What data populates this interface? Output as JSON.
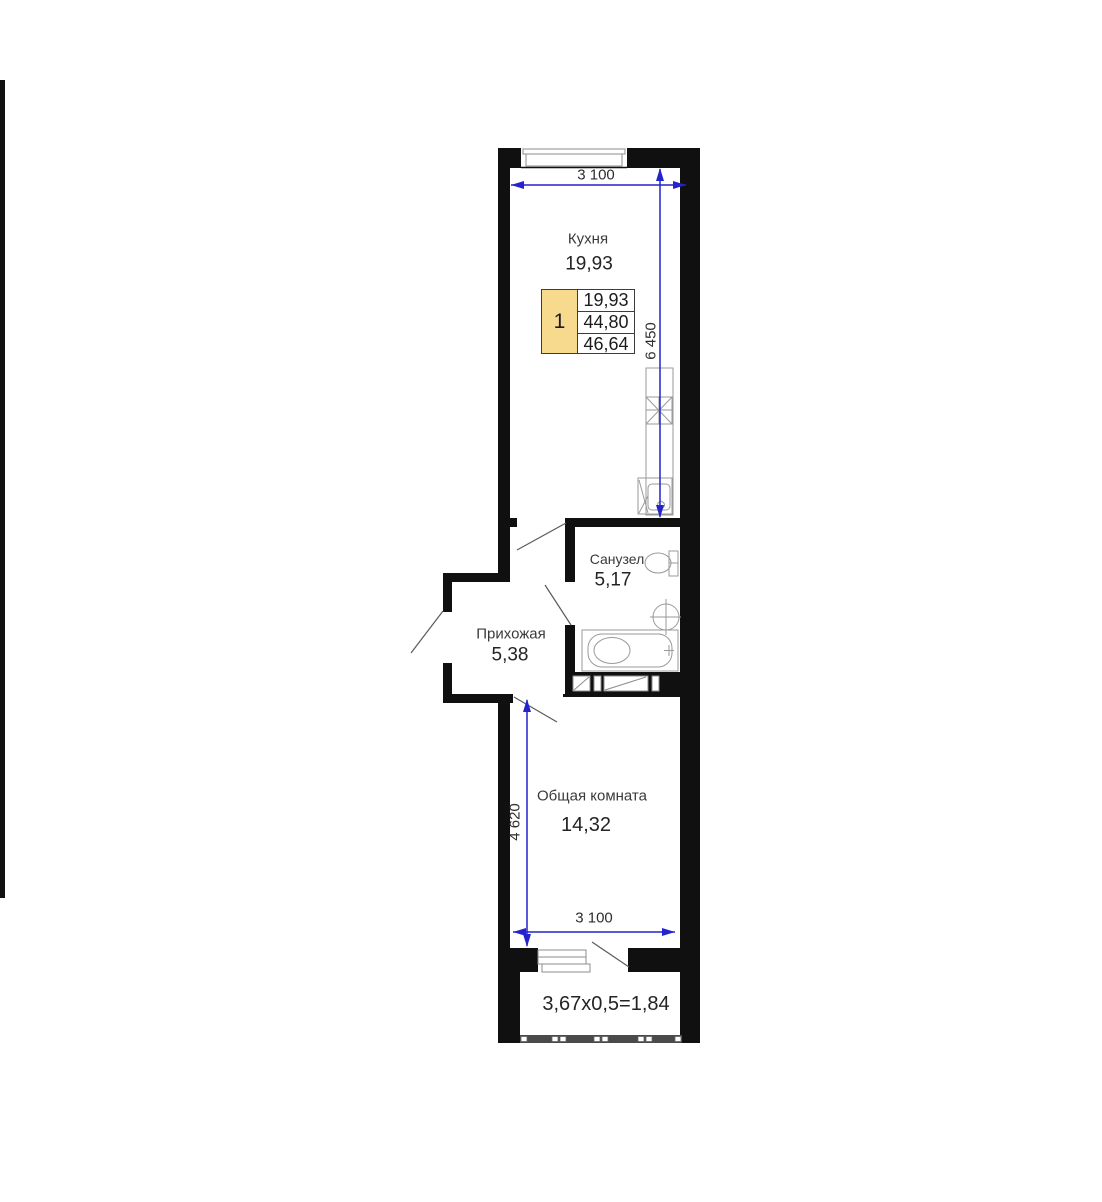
{
  "rooms": {
    "kitchen": {
      "name": "Кухня",
      "area": "19,93"
    },
    "bathroom": {
      "name": "Санузел",
      "area": "5,17"
    },
    "hallway": {
      "name": "Прихожая",
      "area": "5,38"
    },
    "living": {
      "name": "Общая комната",
      "area": "14,32"
    }
  },
  "balcony": {
    "area_formula": "3,67x0,5=1,84"
  },
  "legend": {
    "unit_number": "1",
    "rows": [
      "19,93",
      "44,80",
      "46,64"
    ]
  },
  "dimensions": {
    "top_width": "3 100",
    "kitchen_height": "6 450",
    "living_height": "4 620",
    "bottom_width": "3 100"
  },
  "fixtures": [
    "stove",
    "kitchen-sink",
    "toilet",
    "washbasin",
    "bathtub",
    "window",
    "balcony-glazing"
  ],
  "colors": {
    "wall": "#101010",
    "dimension": "#2424cc",
    "legend_highlight": "#f8da8e",
    "fixture_line": "#9a9a9a"
  }
}
